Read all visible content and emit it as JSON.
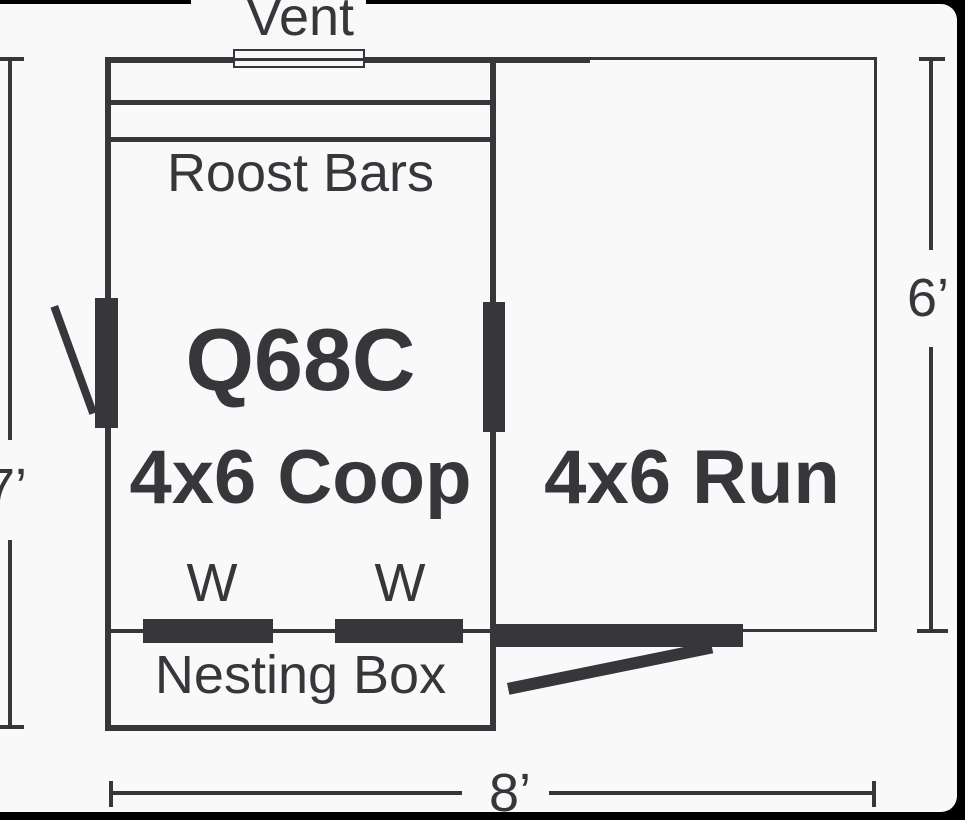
{
  "labels": {
    "vent": "Vent",
    "roost_bars": "Roost Bars",
    "coop_model": "Q68C",
    "coop_size": "4x6 Coop",
    "run_size": "4x6 Run",
    "window_left": "W",
    "window_right": "W",
    "nesting_box": "Nesting Box",
    "dim_coop_height": "7’",
    "dim_run_height": "6’",
    "dim_total_width": "8’"
  },
  "colors": {
    "ink": "#36363b",
    "background": "#f9f9fa",
    "frame": "#000000"
  }
}
